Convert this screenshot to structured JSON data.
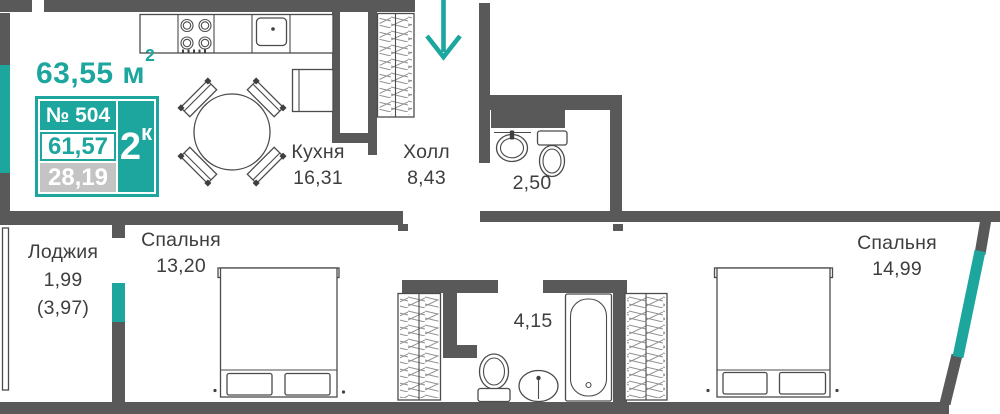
{
  "header": {
    "total_area_value": "63,55",
    "total_area_unit": " м",
    "total_area_sup": "2"
  },
  "badge": {
    "number": "№ 504",
    "rooms_value": "2",
    "rooms_sup": "к",
    "living_area": "61,57",
    "extra_area": "28,19"
  },
  "rooms": {
    "kitchen": {
      "name": "Кухня",
      "area": "16,31"
    },
    "hall": {
      "name": "Холл",
      "area": "8,43"
    },
    "bathroom_small": {
      "area": "2,50"
    },
    "bathroom_large": {
      "area": "4,15"
    },
    "bedroom_left": {
      "name": "Спальня",
      "area": "13,20"
    },
    "bedroom_right": {
      "name": "Спальня",
      "area": "14,99"
    },
    "loggia": {
      "name": "Лоджия",
      "area": "1,99",
      "area_full": "(3,97)"
    }
  },
  "colors": {
    "accent_teal": "#1CA69E",
    "wall": "#59595A",
    "area_gray": "#C4C4C4"
  }
}
